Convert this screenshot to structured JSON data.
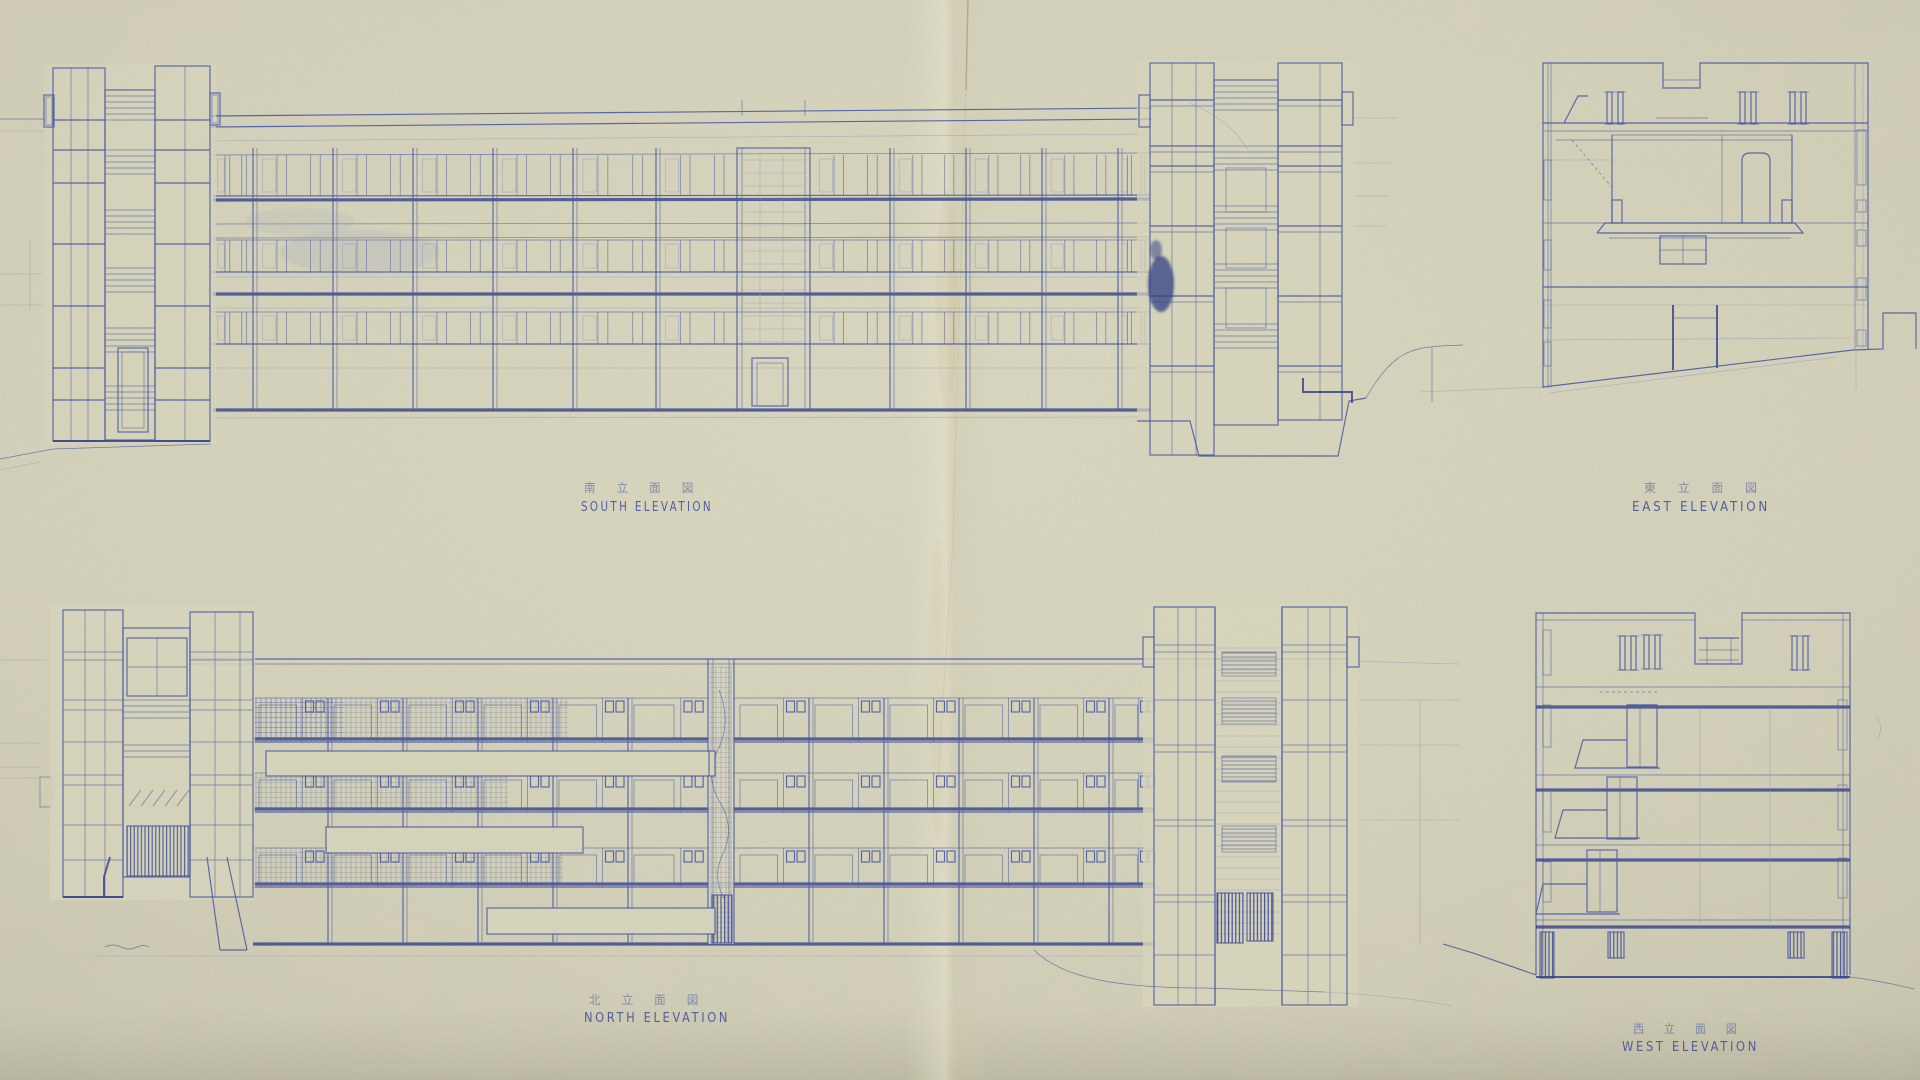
{
  "drawing": {
    "kind": "architectural blueprint, four building elevations, blue ink on aged paper"
  },
  "labels": {
    "south": {
      "jp": "南 立 面 図",
      "en": "SOUTH  ELEVATION"
    },
    "east": {
      "jp": "東 立 面 図",
      "en": "EAST   ELEVATION"
    },
    "north": {
      "jp": "北 立 面 図",
      "en": "NORTH   ELEVATION"
    },
    "west": {
      "jp": "西 立 面 図",
      "en": "WEST  ELEVATION"
    }
  },
  "colors": {
    "paper": "#d6d3bb",
    "paper_shadow": "#bdbaa2",
    "ink": "#4d5ca4",
    "ink_heavy": "#33418b",
    "ink_faint": "#8791bd",
    "ink_blot": "#2c3a82",
    "crease": "#b3a077"
  }
}
